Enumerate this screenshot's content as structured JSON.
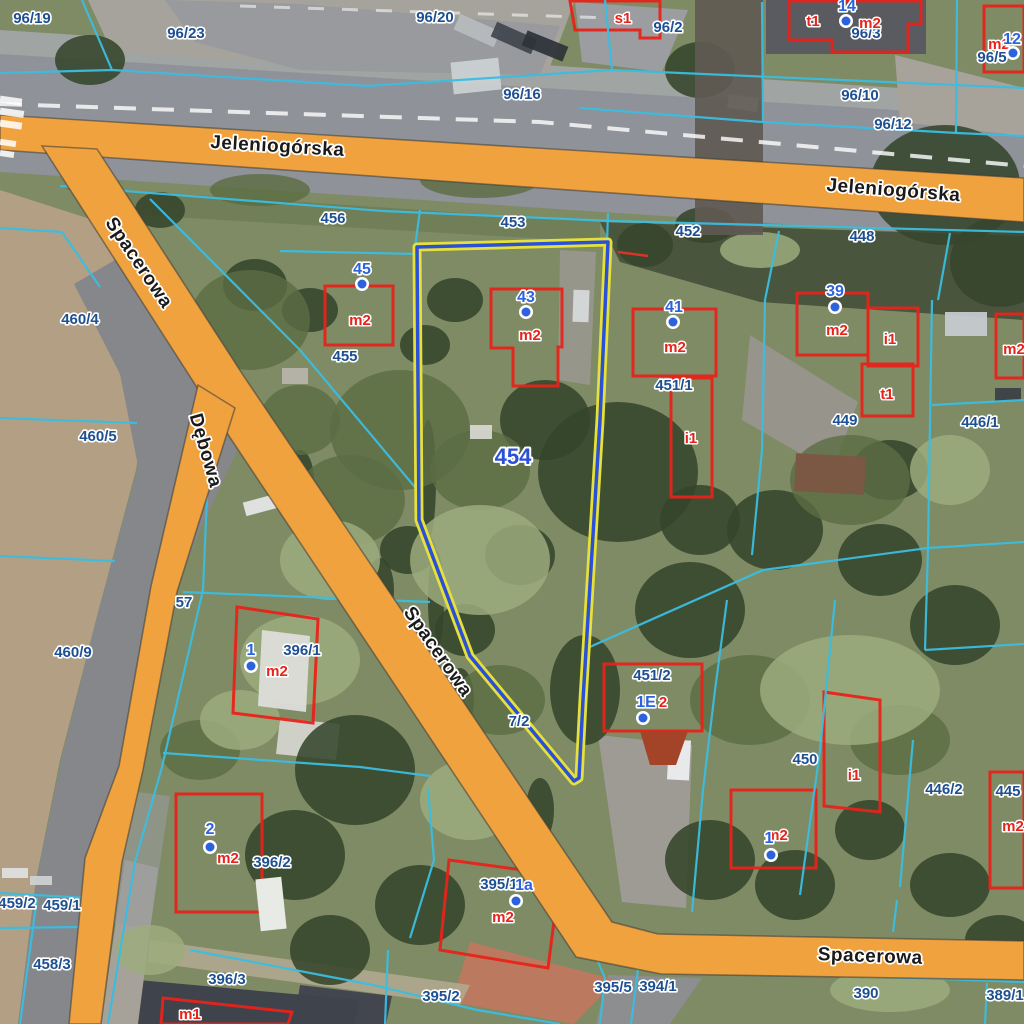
{
  "map": {
    "type": "cadastral-aerial-map",
    "colors": {
      "road_orange": "#f0a23f",
      "road_casing": "#3a3a3a",
      "parcel_line_cyan": "#3bbde0",
      "building_red": "#da3428",
      "label_navy": "#1d4f91",
      "label_red": "#e8231a",
      "address_blue": "#2e62dd",
      "selected_yellow": "#e6e03a",
      "selected_blue": "#2b50d8"
    },
    "streets": [
      {
        "name": "Jeleniogórska",
        "x": 277,
        "y": 152,
        "rotate": 3.5
      },
      {
        "name": "Jeleniogórska",
        "x": 893,
        "y": 196,
        "rotate": 4.5
      },
      {
        "name": "Spacerowa",
        "x": 134,
        "y": 266,
        "rotate": 56
      },
      {
        "name": "Dębowa",
        "x": 200,
        "y": 452,
        "rotate": 74
      },
      {
        "name": "Spacerowa",
        "x": 433,
        "y": 655,
        "rotate": 55
      },
      {
        "name": "Spacerowa",
        "x": 870,
        "y": 962,
        "rotate": 2
      }
    ],
    "selected_parcel": {
      "label": "454"
    },
    "parcel_labels": [
      {
        "t": "96/19",
        "x": 32,
        "y": 23
      },
      {
        "t": "96/23",
        "x": 186,
        "y": 38
      },
      {
        "t": "96/20",
        "x": 435,
        "y": 22
      },
      {
        "t": "96/2",
        "x": 668,
        "y": 32
      },
      {
        "t": "96/16",
        "x": 522,
        "y": 99
      },
      {
        "t": "96/3",
        "x": 866,
        "y": 38
      },
      {
        "t": "96/5",
        "x": 992,
        "y": 62
      },
      {
        "t": "96/10",
        "x": 860,
        "y": 100
      },
      {
        "t": "96/12",
        "x": 893,
        "y": 129
      },
      {
        "t": "456",
        "x": 333,
        "y": 223
      },
      {
        "t": "453",
        "x": 513,
        "y": 227
      },
      {
        "t": "452",
        "x": 688,
        "y": 236
      },
      {
        "t": "448",
        "x": 862,
        "y": 241
      },
      {
        "t": "460/4",
        "x": 80,
        "y": 324
      },
      {
        "t": "455",
        "x": 345,
        "y": 361
      },
      {
        "t": "460/5",
        "x": 98,
        "y": 441
      },
      {
        "t": "451/1",
        "x": 674,
        "y": 390
      },
      {
        "t": "449",
        "x": 845,
        "y": 425
      },
      {
        "t": "446/1",
        "x": 980,
        "y": 427
      },
      {
        "t": "454",
        "x": 513,
        "y": 464,
        "cls": "selected"
      },
      {
        "t": "57",
        "x": 184,
        "y": 607
      },
      {
        "t": "460/9",
        "x": 73,
        "y": 657
      },
      {
        "t": "396/1",
        "x": 302,
        "y": 655
      },
      {
        "t": "451/2",
        "x": 652,
        "y": 680
      },
      {
        "t": "7/2",
        "x": 519,
        "y": 726
      },
      {
        "t": "450",
        "x": 805,
        "y": 764
      },
      {
        "t": "446/2",
        "x": 944,
        "y": 794
      },
      {
        "t": "445",
        "x": 1008,
        "y": 796
      },
      {
        "t": "459/2",
        "x": 17,
        "y": 908
      },
      {
        "t": "459/1",
        "x": 62,
        "y": 910
      },
      {
        "t": "396/2",
        "x": 272,
        "y": 867
      },
      {
        "t": "395/1",
        "x": 499,
        "y": 889
      },
      {
        "t": "458/3",
        "x": 52,
        "y": 969
      },
      {
        "t": "396/3",
        "x": 227,
        "y": 984
      },
      {
        "t": "395/2",
        "x": 441,
        "y": 1001
      },
      {
        "t": "395/5",
        "x": 613,
        "y": 992
      },
      {
        "t": "394/1",
        "x": 658,
        "y": 991
      },
      {
        "t": "390",
        "x": 866,
        "y": 998
      },
      {
        "t": "389/1",
        "x": 1005,
        "y": 1000
      }
    ],
    "building_labels": [
      {
        "t": "s1",
        "x": 623,
        "y": 23
      },
      {
        "t": "t1",
        "x": 813,
        "y": 26
      },
      {
        "t": "m2",
        "x": 870,
        "y": 28
      },
      {
        "t": "m2",
        "x": 999,
        "y": 49
      },
      {
        "t": "m2",
        "x": 360,
        "y": 325
      },
      {
        "t": "m2",
        "x": 530,
        "y": 340
      },
      {
        "t": "m2",
        "x": 675,
        "y": 352
      },
      {
        "t": "m2",
        "x": 837,
        "y": 335
      },
      {
        "t": "i1",
        "x": 890,
        "y": 344
      },
      {
        "t": "m2",
        "x": 1014,
        "y": 354
      },
      {
        "t": "t1",
        "x": 887,
        "y": 399
      },
      {
        "t": "i1",
        "x": 691,
        "y": 443
      },
      {
        "t": "m2",
        "x": 277,
        "y": 676
      },
      {
        "t": "2",
        "x": 663,
        "y": 707
      },
      {
        "t": "i1",
        "x": 854,
        "y": 780
      },
      {
        "t": "m2",
        "x": 777,
        "y": 840
      },
      {
        "t": "m2",
        "x": 1013,
        "y": 831
      },
      {
        "t": "m2",
        "x": 228,
        "y": 863
      },
      {
        "t": "m2",
        "x": 503,
        "y": 922
      },
      {
        "t": "m1",
        "x": 190,
        "y": 1019
      }
    ],
    "address_points": [
      {
        "label": "14",
        "x": 846,
        "y": 21,
        "lx": 847,
        "ly": 11
      },
      {
        "label": "12",
        "x": 1013,
        "y": 53,
        "lx": 1012,
        "ly": 44
      },
      {
        "label": "45",
        "x": 362,
        "y": 284,
        "lx": 362,
        "ly": 274
      },
      {
        "label": "43",
        "x": 526,
        "y": 312,
        "lx": 526,
        "ly": 302
      },
      {
        "label": "41",
        "x": 673,
        "y": 322,
        "lx": 674,
        "ly": 312
      },
      {
        "label": "39",
        "x": 835,
        "y": 307,
        "lx": 835,
        "ly": 296
      },
      {
        "label": "1",
        "x": 251,
        "y": 666,
        "lx": 251,
        "ly": 655
      },
      {
        "label": "1E",
        "x": 643,
        "y": 718,
        "lx": 646,
        "ly": 707
      },
      {
        "label": "2",
        "x": 210,
        "y": 847,
        "lx": 210,
        "ly": 834
      },
      {
        "label": "1",
        "x": 771,
        "y": 855,
        "lx": 769,
        "ly": 843
      },
      {
        "label": "1a",
        "x": 516,
        "y": 901,
        "lx": 524,
        "ly": 890
      }
    ]
  }
}
